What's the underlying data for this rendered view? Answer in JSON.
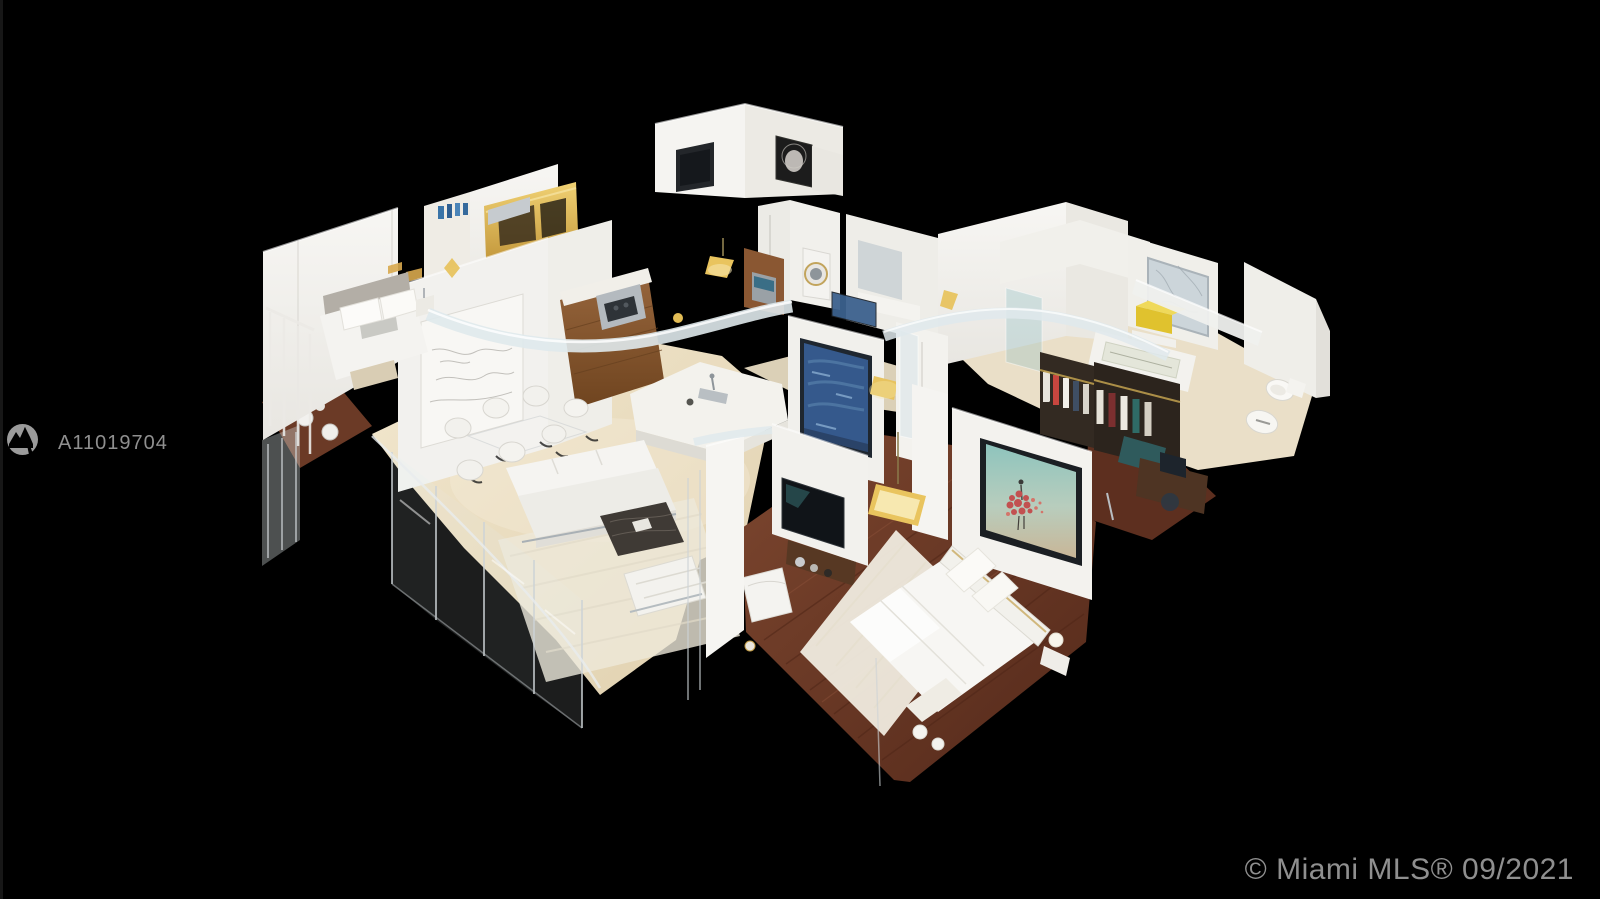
{
  "image": {
    "description": "3D dollhouse cutaway view of a furnished luxury condo: living room with white sofa and dining chairs, open kitchen with wood cabinets and white island, guest bedroom, master bedroom with white bed on dark wood floor, walk-in closet with hanging clothes, and marble bathrooms with tub and toilets, shown floating on a black background"
  },
  "watermark": {
    "mls_id": "A11019704"
  },
  "footer": {
    "copyright": "© Miami MLS® 09/2021"
  },
  "colors": {
    "background": "#000000",
    "edge_strip": "#171717",
    "watermark_text": "#8f8f8f",
    "copyright_text": "#8f8f8f",
    "logo_gray": "#9b9b9b",
    "wall_white": "#f2f1ed",
    "floor_cream": "#ead9bd",
    "floor_wood_dark": "#6b3726",
    "cabinet_wood": "#8a5732",
    "accent_gold": "#e9c45e",
    "painting_blue": "#35598c",
    "art_teal": "#8ec4bd"
  }
}
